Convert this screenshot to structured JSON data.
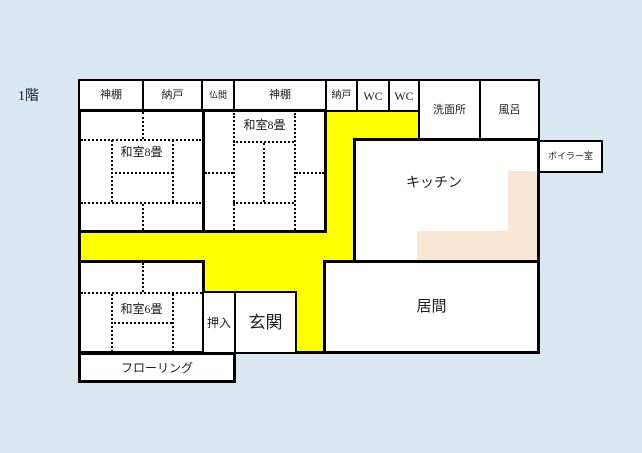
{
  "floor_label": "1階",
  "colors": {
    "background": "#d9e8f0",
    "corridor_yellow": "#ffff00",
    "counter_peach": "#fae6d5",
    "wall_black": "#000000",
    "room_white": "#ffffff",
    "text": "#1c1c24"
  },
  "rooms": {
    "kamidana_1": "神棚",
    "nando_1": "納戸",
    "butsuma": "仏間",
    "kamidana_2": "神棚",
    "nando_2": "納戸",
    "wc_1": "WC",
    "wc_2": "WC",
    "senmenjo": "洗面所",
    "furo": "風呂",
    "washitsu8_left": "和室8畳",
    "washitsu8_center": "和室8畳",
    "kitchen": "キッチン",
    "boiler": "ボイラー室",
    "washitsu6": "和室6畳",
    "oshiire": "押入",
    "genkan": "玄関",
    "ima": "居間",
    "flooring": "フローリング"
  }
}
